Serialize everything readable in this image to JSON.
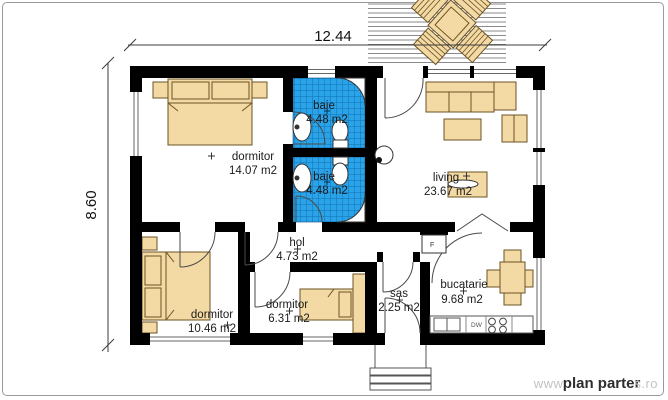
{
  "plan": {
    "dim_width": "12.44",
    "dim_height": "8.60",
    "rooms": [
      {
        "id": "dormitor-1",
        "name": "dormitor",
        "area": "14.07 m2"
      },
      {
        "id": "baie-1",
        "name": "baie",
        "area": "4.48 m2"
      },
      {
        "id": "baie-2",
        "name": "baie",
        "area": "4.48 m2"
      },
      {
        "id": "living",
        "name": "living",
        "area": "23.67 m2"
      },
      {
        "id": "hol",
        "name": "hol",
        "area": "4.73 m2"
      },
      {
        "id": "dormitor-2",
        "name": "dormitor",
        "area": "10.46 m2"
      },
      {
        "id": "dormitor-3",
        "name": "dormitor",
        "area": "6.31 m2"
      },
      {
        "id": "sas",
        "name": "sas",
        "area": "2.25 m2"
      },
      {
        "id": "bucatarie",
        "name": "bucatarie",
        "area": "9.68 m2"
      }
    ],
    "appliances": {
      "fridge_label": "F",
      "dishwasher_label": "DW"
    },
    "watermark": {
      "prefix": "www.",
      "brand": "plan parter",
      "suffix": "s.ro"
    },
    "colors": {
      "wall": "#000000",
      "tile_blue": "#2aa3e8",
      "tile_grid": "#1172b4",
      "furniture_tan": "#f3d9a4",
      "furniture_outline": "#6b5323"
    }
  }
}
